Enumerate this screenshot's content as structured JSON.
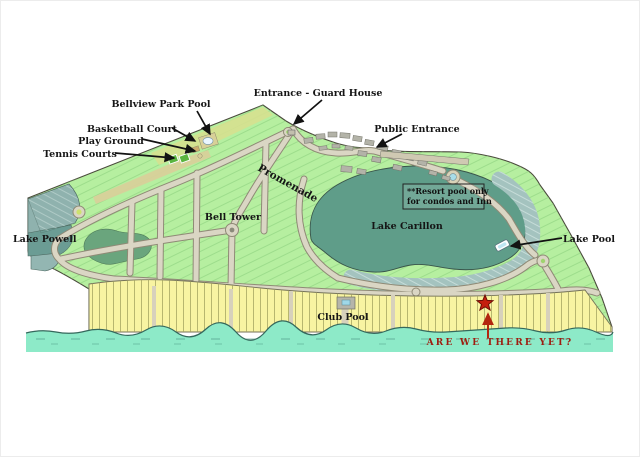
{
  "map": {
    "region_labels": {
      "lake_powell": "Lake Powell",
      "lake_carillon": "Lake Carillon",
      "promenade": "Promenade",
      "bell_tower": "Bell Tower"
    },
    "amenity_labels": {
      "bellview_park_pool": "Bellview Park Pool",
      "basketball_court": "Basketball Court",
      "play_ground": "Play Ground",
      "tennis_courts": "Tennis Courts",
      "entrance_guard_house": "Entrance - Guard House",
      "public_entrance": "Public Entrance",
      "lake_pool": "Lake Pool",
      "club_pool": "Club Pool"
    },
    "note_box": {
      "line1": "**Resort pool only",
      "line2": "for condos and Inn"
    },
    "marker": {
      "caption": "ARE WE THERE YET?"
    },
    "colors": {
      "land_green": "#b6efa0",
      "beach_yellow": "#f8f4a2",
      "gulf_water": "#8deac8",
      "lake_green": "#5f9d89",
      "lake_powell_teal": "#8fb2ae",
      "woods_green": "#6aa57d",
      "condo_band": "#a4c3bf",
      "road_fill": "#dad6c4",
      "marker_red": "#c41e0e",
      "caption_red": "#9e1d10",
      "label_black": "#151515"
    }
  }
}
